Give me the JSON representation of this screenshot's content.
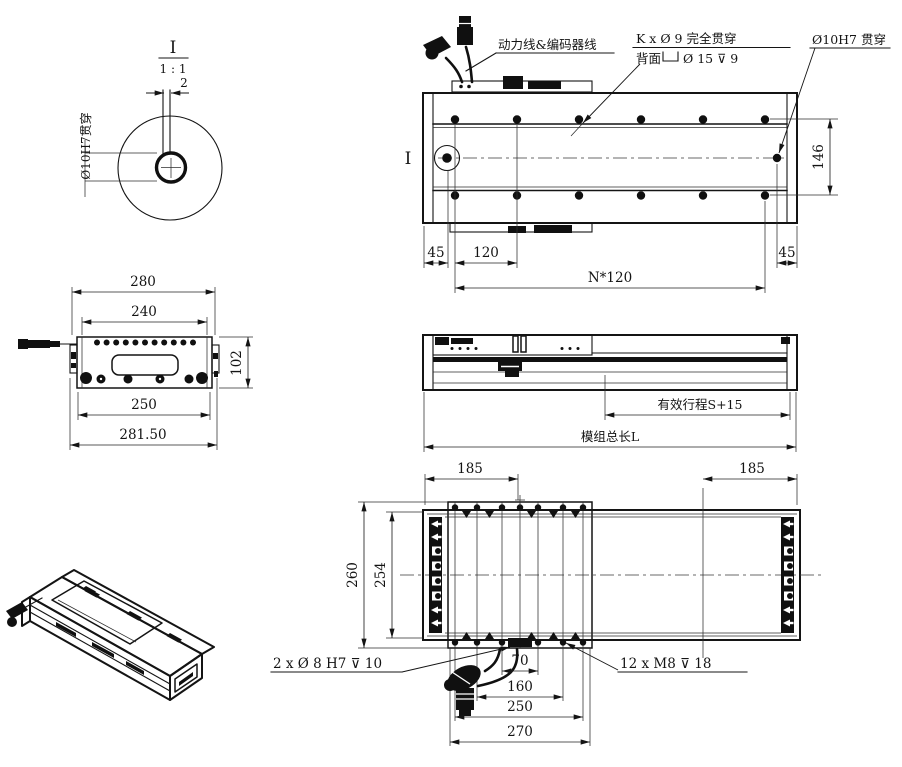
{
  "drawing": {
    "detail_view": {
      "title": "I",
      "scale": "1 : 1",
      "dim_slot_width": "2",
      "hole_label": "Ø10H7贯穿"
    },
    "top_view": {
      "section_label": "I",
      "cable_callout": "动力线&编码器线",
      "mount_hole_callout_line1": "K x Ø 9 完全贯穿",
      "mount_hole_callout_line2_prefix": "背面",
      "mount_hole_callout_line2_suffix": "Ø 15 ⊽ 9",
      "pin_hole_callout": "Ø10H7 贯穿",
      "dim_left_margin": "45",
      "dim_pitch": "120",
      "dim_total_pitch": "N*120",
      "dim_right_margin": "45",
      "dim_hole_row_width": "146"
    },
    "end_view": {
      "dim_width_280": "280",
      "dim_width_240": "240",
      "dim_height_102": "102",
      "dim_width_250": "250",
      "dim_width_281_50": "281.50"
    },
    "side_view": {
      "stroke_dim": "有效行程S+15",
      "total_length_dim": "模组总长L"
    },
    "bottom_view": {
      "dim_185_left": "185",
      "dim_185_right": "185",
      "dim_260": "260",
      "dim_254": "254",
      "dim_70": "70",
      "dim_160": "160",
      "dim_250": "250",
      "dim_270": "270",
      "dowel_callout": "2 x Ø 8 H7 ⊽ 10",
      "thread_callout": "12 x  M8 ⊽ 18"
    }
  }
}
